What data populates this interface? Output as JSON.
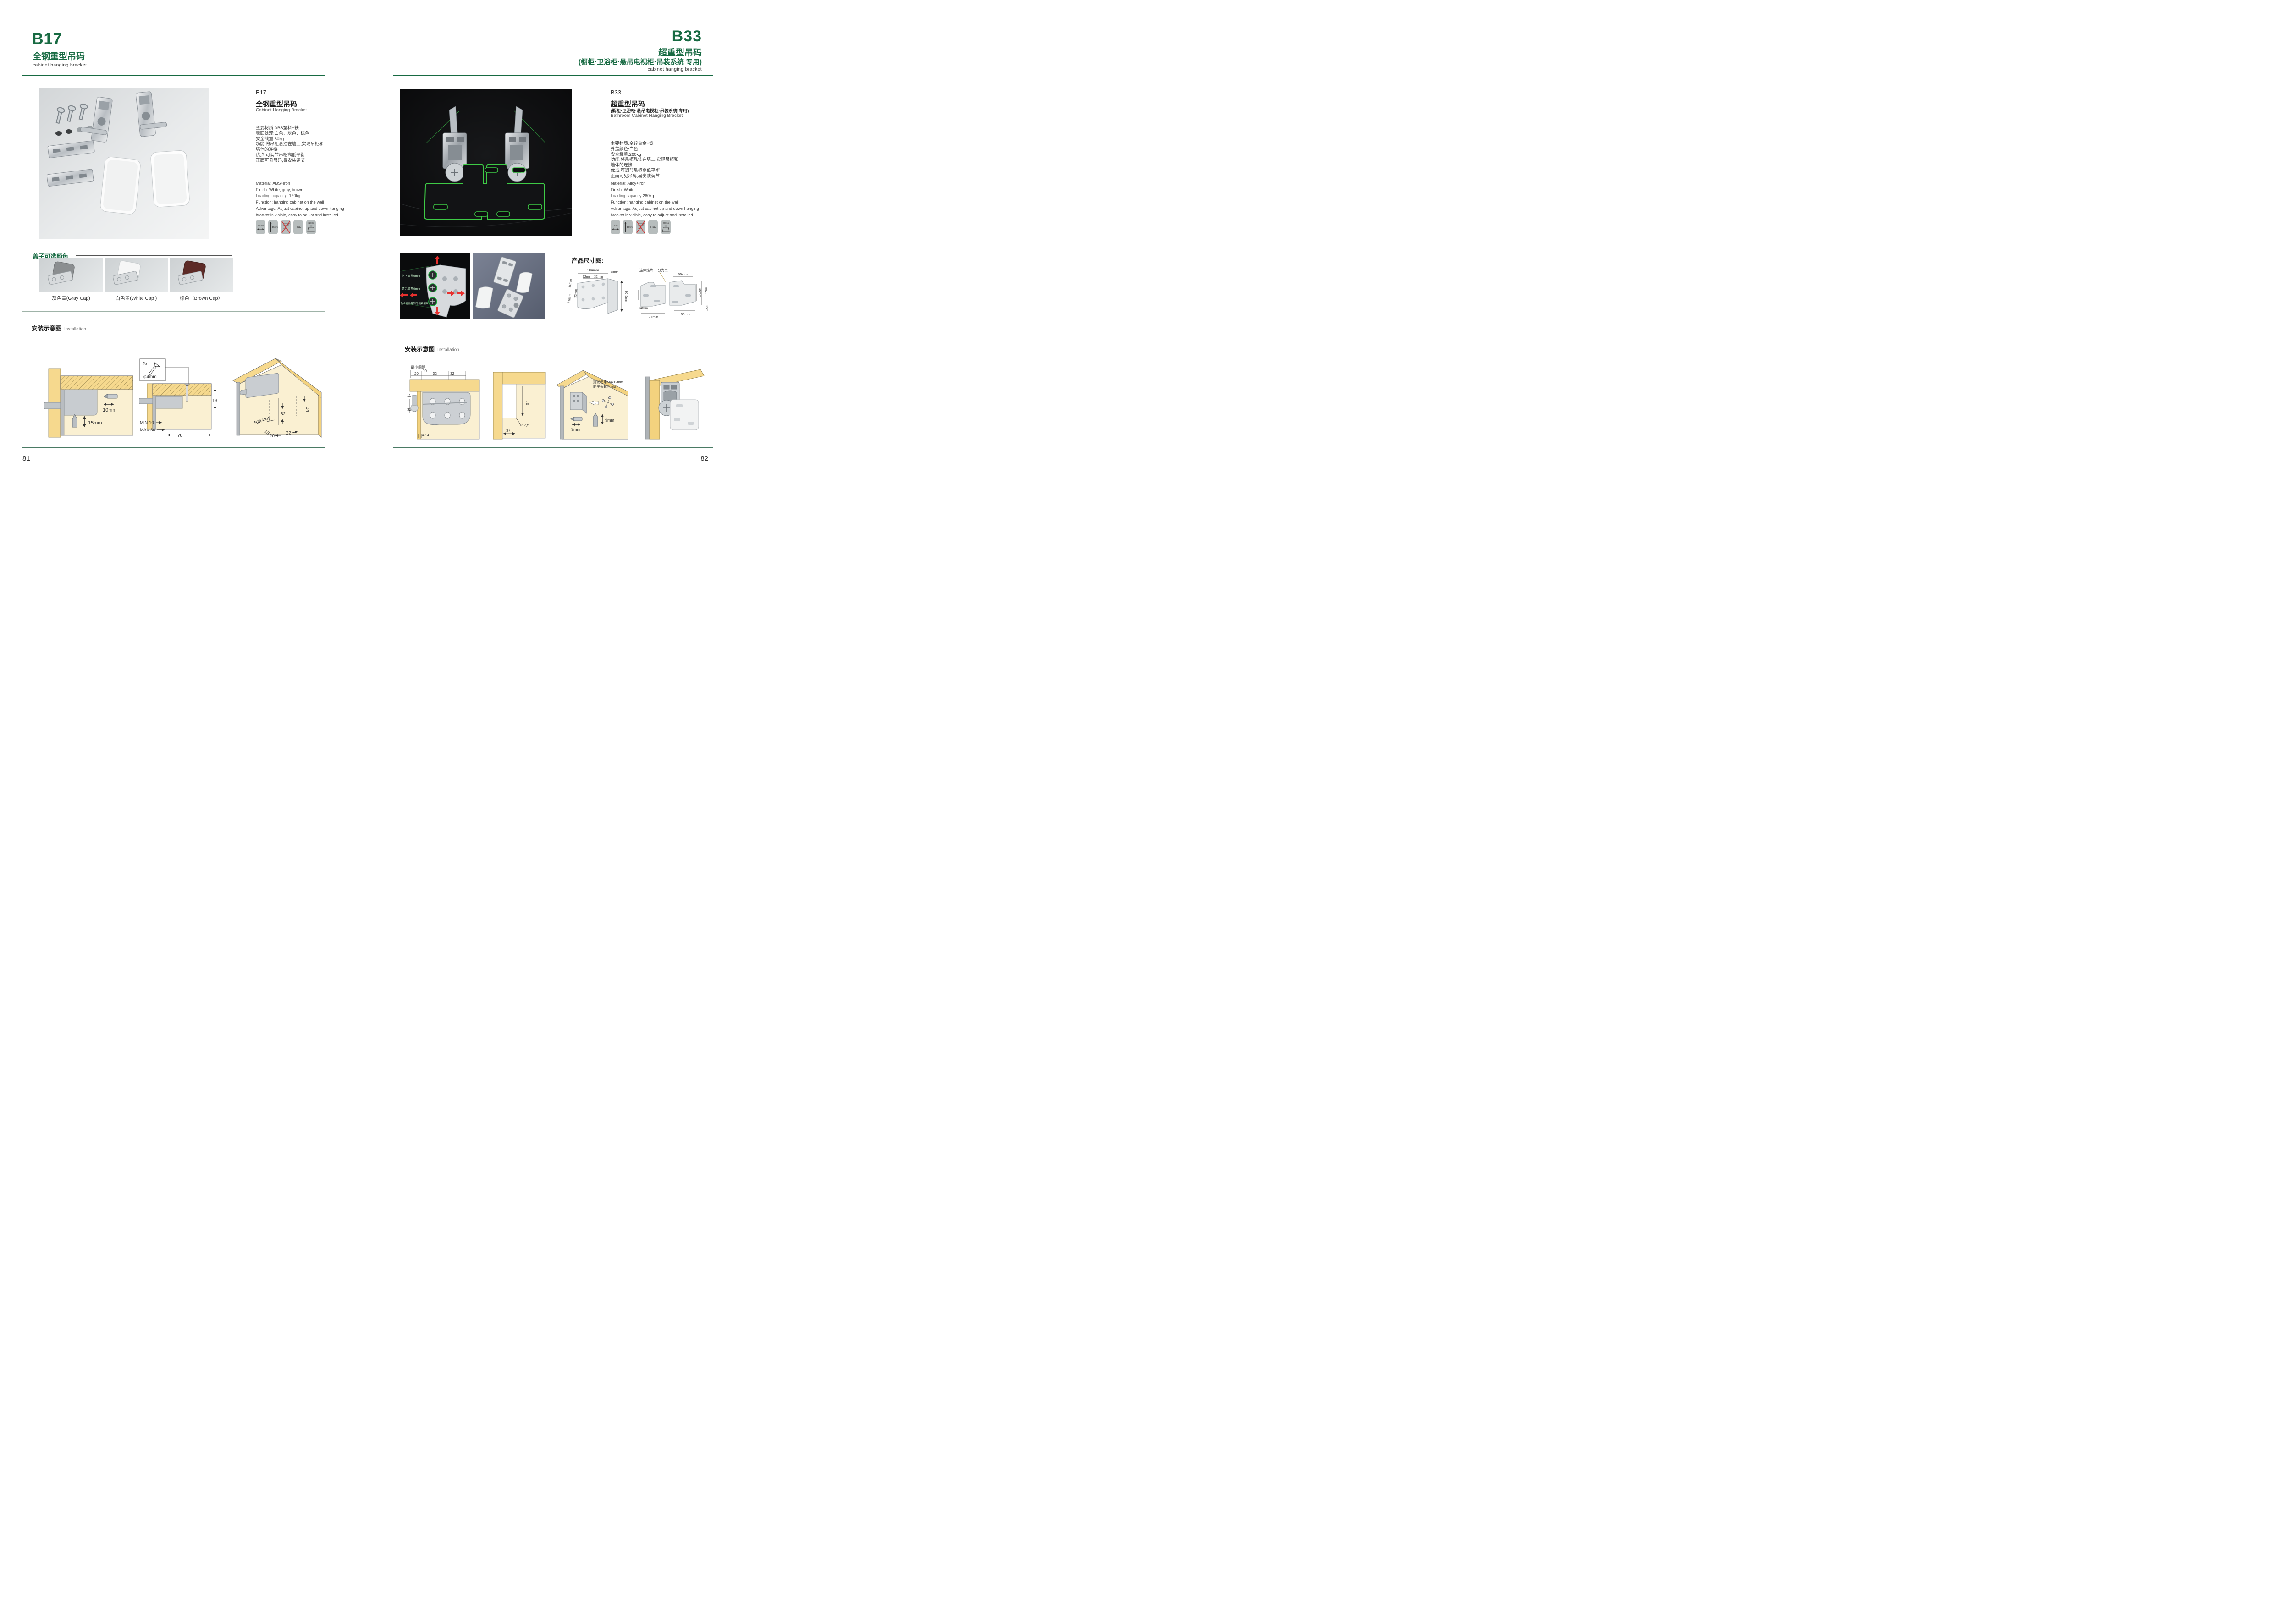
{
  "page": {
    "left_no": "81",
    "right_no": "82"
  },
  "colors": {
    "accent_green": "#176a42",
    "icon_bg": "#b7bdbd",
    "wood_yellow": "#f6d98e",
    "cream": "#faf0d2",
    "arrow_red": "#d8262b",
    "photo_green": "#3ecb46",
    "cap_gray": "#8b8e90",
    "cap_white": "#f4f4f4",
    "cap_brown": "#5d2b27"
  },
  "left": {
    "header": {
      "code": "B17",
      "title": "全钢重型吊码",
      "subtitle": "cabinet hanging bracket"
    },
    "col": {
      "code": "B17",
      "title": "全钢重型吊码",
      "title_en": "Cabinet Hanging Bracket"
    },
    "specs_cn": [
      "主要材质:ABS塑料+铁",
      "表面处理:白色、灰色、棕色",
      "安全载重:80kg",
      "功能:将吊柜悬挂在墙上,实现吊柜和",
      "墙体的连接",
      "优点:可调节吊柜高低平衡",
      "正面可见吊码,易安装调节"
    ],
    "specs_en": [
      "Material: ABS+iron",
      "Finish: White, gray, brown",
      "Loading capacity: 120kg",
      "Function: hanging cabinet on the wall",
      "Advantage: Adjust cabinet up and down hanging",
      "bracket is visible, easy to adjust and installed"
    ],
    "icons": {
      "i1": "10mm",
      "i2": "15mm",
      "i3": "no-drill",
      "i4": "LGA",
      "i5": "120Kg"
    },
    "caps": {
      "label": "盖子可选颜色",
      "c1": "灰色盖(Gray Cap)",
      "c2": "白色盖(White Cap )",
      "c3": "棕色（Brown Cap）"
    },
    "install": {
      "label": "安装示意图",
      "label_en": "Installation",
      "d1": {
        "l1": "10mm",
        "l2": "15mm"
      },
      "d2": {
        "qty": "2x",
        "dia": "φ4mm",
        "h": "13",
        "min": "MIN.10",
        "max": "MAX.30",
        "w": "78"
      },
      "d3": {
        "a": "34",
        "b": "32",
        "c": "RMAX4",
        "d": "18",
        "e": "20",
        "f": "32"
      }
    }
  },
  "right": {
    "header": {
      "code": "B33",
      "title": "超重型吊码",
      "paren": "(橱柜·卫浴柜·悬吊电视柜·吊装系统 专用)",
      "subtitle": "cabinet hanging bracket"
    },
    "col": {
      "code": "B33",
      "title": "超重型吊码",
      "paren": "(橱柜·卫浴柜·悬吊电视柜·吊装系统 专用)",
      "title_en": "Bathroom Cabinet Hanging Bracket"
    },
    "specs_cn": [
      "主要材质:全锌合金+铁",
      "外盖颜色:白色",
      "安全载重:260kg",
      "功能:将吊柜悬挂在墙上,实现吊柜和",
      "墙体的连接",
      "优点:可调节吊柜高低平衡",
      "正面可见吊码,易安装调节"
    ],
    "specs_en": [
      "Material: Alloy+iron",
      "Finish: White",
      "Loading capacity:260kg",
      "Function: hanging cabinet on the wall",
      "Advantage: Adjust cabinet up and down hanging",
      "bracket is visible, easy to adjust and installed"
    ],
    "icons": {
      "i1": "12mm",
      "i2": "13mm",
      "i3": "no-drill",
      "i4": "LGA",
      "i5": "260Kg"
    },
    "thumb1": {
      "t1": "上下调节9mm",
      "t2": "前后调节9mm",
      "t3": "防止柜体翻转的锁紧螺丝"
    },
    "dims": {
      "label": "产品尺寸图:",
      "d1": {
        "w": "104mm",
        "p1": "32mm",
        "p2": "32mm",
        "side": "39mm",
        "t": "11mm",
        "l": "51mm",
        "l2": "32mm",
        "h": "80.5mm"
      },
      "d2": {
        "note": "连体挂片 一分为二",
        "a": "55mm",
        "b": "39mm",
        "c": "55mm",
        "d": "8mm",
        "e": "63mm",
        "f": "77mm",
        "g": "12mm",
        "h": "17mm"
      }
    },
    "install": {
      "label": "安装示意图",
      "label_en": "Installation",
      "d1": {
        "note": "最小间距",
        "a": "20",
        "b": "10",
        "c": "32",
        "d": "32",
        "e": "11",
        "f": "32",
        "g": "4-14"
      },
      "d2": {
        "a": "78",
        "b": "R 2,5",
        "c": "37"
      },
      "d3": {
        "n1": "建议使用M4x12mm",
        "n2": "的平头螺丝固定",
        "a": "9mm",
        "b": "9mm"
      }
    }
  }
}
